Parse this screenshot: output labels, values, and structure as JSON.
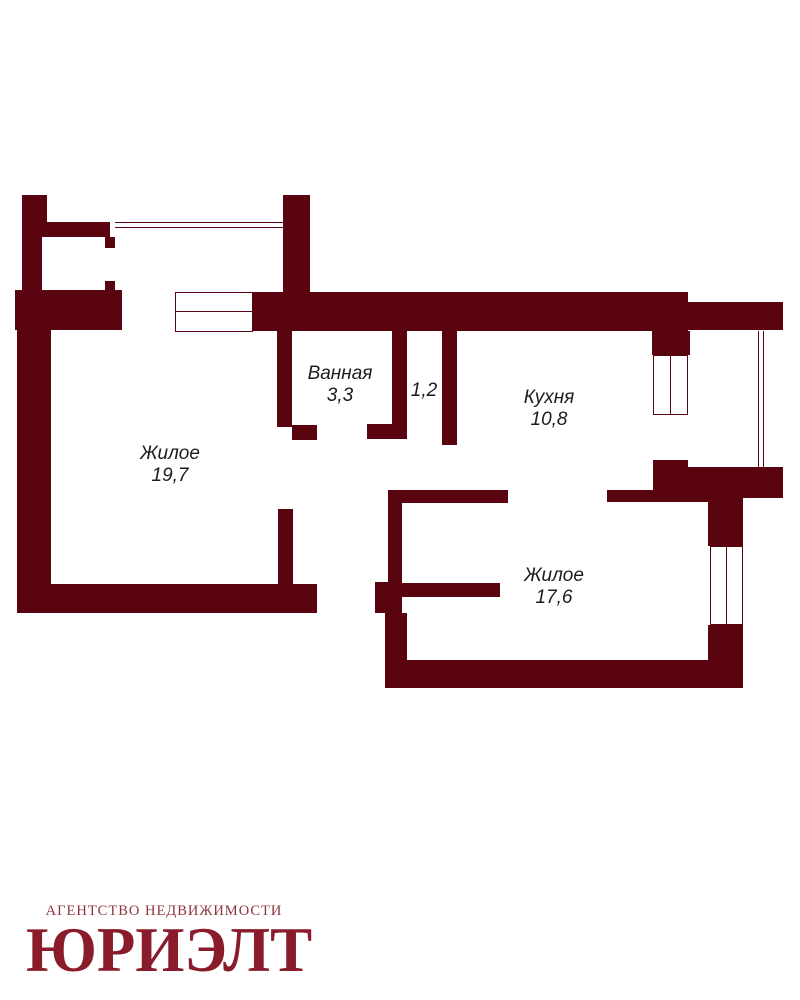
{
  "palette": {
    "wall": "#5a040f",
    "label": "#1c1c1c",
    "logo_primary": "#8a1b2b",
    "logo_secondary": "#8d343d",
    "background": "#ffffff"
  },
  "rooms": [
    {
      "name": "Жилое",
      "area": "19,7"
    },
    {
      "name": "Ванная",
      "area": "3,3"
    },
    {
      "name": "",
      "area": "1,2"
    },
    {
      "name": "Кухня",
      "area": "10,8"
    },
    {
      "name": "Жилое",
      "area": "17,6"
    }
  ],
  "logo": {
    "tagline": "АГЕНТСТВО НЕДВИЖИМОСТИ",
    "brand": "ЮРИЭЛТ"
  }
}
